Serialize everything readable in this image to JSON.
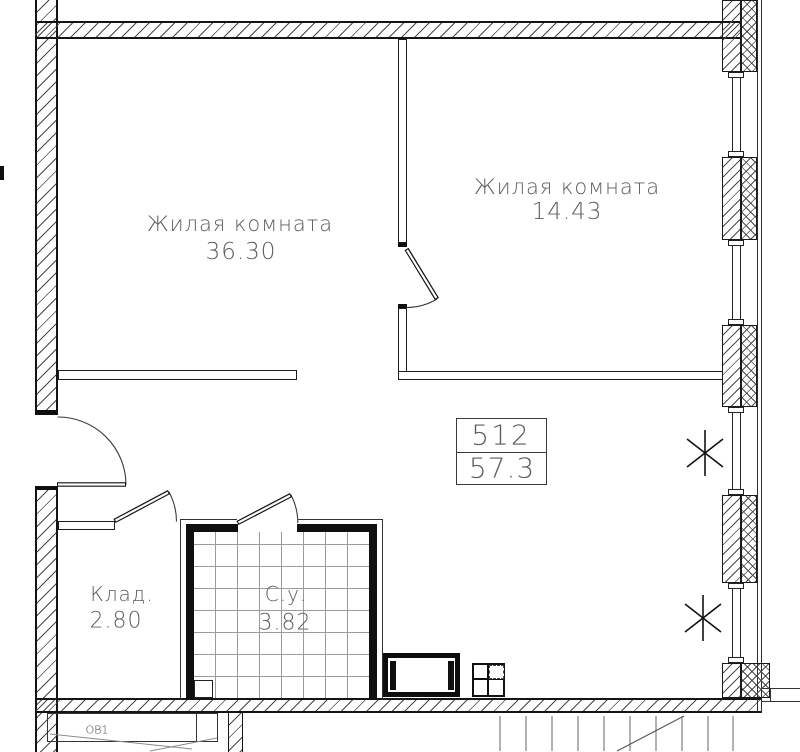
{
  "drawing": {
    "rooms": [
      {
        "name": "Жилая комната",
        "area": "36.30"
      },
      {
        "name": "Жилая комната",
        "area": "14.43"
      },
      {
        "name": "Клад.",
        "area": "2.80"
      },
      {
        "name": "С.у.",
        "area": "3.82"
      }
    ],
    "stamp": {
      "number": "512",
      "total_area": "57.3"
    },
    "bottom_label": "ОВ1",
    "colors": {
      "line": "#1a1a1a",
      "text": "#5d5d5d",
      "tile_grid": "#9b9b9b"
    }
  }
}
